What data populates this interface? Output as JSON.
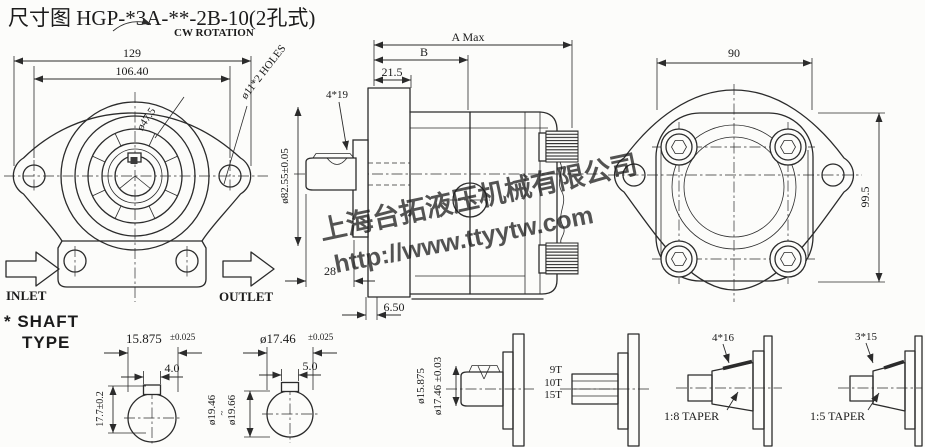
{
  "title": "尺寸图 HGP-*3A-**-2B-10(2孔式)",
  "watermark": {
    "company": "上海台拓液压机械有限公司",
    "url": "http://www.ttyytw.com",
    "color": "#2e7de0"
  },
  "front_view": {
    "rotation": "CW ROTATION",
    "dim_129": "129",
    "dim_106": "106.40",
    "dim_47": "ø47.5",
    "holes": "ø11*2 HOLES",
    "pilot_dia": "ø82.55±0.05",
    "inlet": "INLET",
    "outlet": "OUTLET"
  },
  "side_view": {
    "dim_a": "A Max",
    "dim_b": "B",
    "dim_21": "21.5",
    "key": "4*19",
    "dim_28": "28",
    "dim_650": "6.50"
  },
  "rear_view": {
    "dim_90": "90",
    "dim_99": "99.5"
  },
  "shaft_types": {
    "heading1": "* SHAFT",
    "heading2": "TYPE",
    "key1_dia": "15.875",
    "key1_tol": "±0.025",
    "key1_width": "4.0",
    "key1_height": "17.7±0.2",
    "dia_min": "ø19.46",
    "dia_tilde": "~",
    "dia_max": "ø19.66",
    "key2_dia": "ø17.46",
    "key2_tol": "±0.025",
    "key2_width": "5.0",
    "side_dia1": "ø15.875",
    "side_dia2": "ø17.46 ±0.03",
    "spline_teeth": [
      "9T",
      "10T",
      "15T"
    ],
    "taper1_key": "4*16",
    "taper1_label": "1:8 TAPER",
    "taper2_key": "3*15",
    "taper2_label": "1:5 TAPER"
  }
}
